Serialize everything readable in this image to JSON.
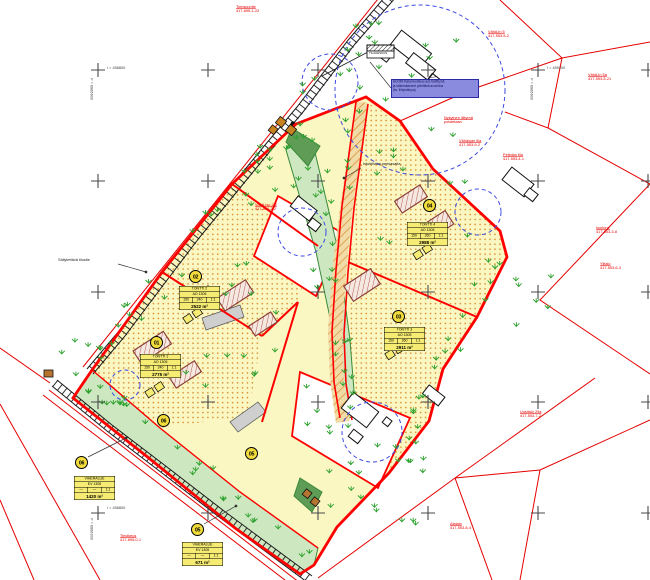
{
  "colors": {
    "boundary": "#FF0000",
    "redline": "#E60000",
    "yellow": "#FAF7C2",
    "table_bg": "#F6EC73",
    "circle_bg": "#F2DC3C",
    "tree": "#2CA02C",
    "green_strip": "#CDE7C0",
    "green_dark": "#5F9C55",
    "tan": "#F1DCA8",
    "hatch_orange": "#D98A2B",
    "hatch_rose": "#B2564E",
    "blue": "#3D49E0",
    "note_bg": "#8A8ADF",
    "note_border": "#2B2BA8",
    "road": "#1A1A1A",
    "cross": "#4A4A4A"
  },
  "note_box": {
    "line1": "HUOM! Rakennettava uusi tieliittymä",
    "line2": "ja näkemäalueet pidettävä avoimina",
    "line3": "(ks. liittymälupa)"
  },
  "tilakeskus_label": "TILAKESKUS",
  "coordinate_crosses": [
    {
      "x_label": "I = 458800",
      "y_label": "P = 6866600"
    },
    {
      "x_label": "I = 459200",
      "y_label": "P = 6866600"
    },
    {
      "x_label": "I = 458800",
      "y_label": "P = 6866200"
    }
  ],
  "parcels": [
    {
      "id": "01",
      "header": "TONTTI 1",
      "code": "AO 1305",
      "c1": "150",
      "c2": "240",
      "c3": "1:1",
      "area": "2775 m²"
    },
    {
      "id": "02",
      "header": "TONTTI 2",
      "code": "AO 1305",
      "c1": "150",
      "c2": "240",
      "c3": "1:1",
      "area": "2522 m²"
    },
    {
      "id": "03",
      "header": "TONTTI 3",
      "code": "AO 1305",
      "c1": "150",
      "c2": "260",
      "c3": "1:1",
      "area": "2911 m²"
    },
    {
      "id": "04",
      "header": "TONTTI 4",
      "code": "AO 1305",
      "c1": "150",
      "c2": "260",
      "c3": "1:1",
      "area": "2988 m²"
    },
    {
      "id": "05",
      "header": "VIHERALUE",
      "code": "EV 1305",
      "c1": "—",
      "c2": "—",
      "c3": "1:1",
      "area": "671 m²"
    },
    {
      "id": "06",
      "header": "VIHERALUE",
      "code": "EV 1305",
      "c1": "—",
      "c2": "—",
      "c3": "1:1",
      "area": "1420 m²"
    }
  ],
  "red_labels": [
    {
      "line1": "Tiensuuntie",
      "line2": "417-895-1-22"
    },
    {
      "line1": "Vähä-In 5",
      "line2": "417-553-5-2"
    },
    {
      "line1": "Vähä-In 5a",
      "line2": "417-553-5-21"
    },
    {
      "line1": "Peltolan tila",
      "line2": "417-553-4-1"
    },
    {
      "line1": "Isorinne",
      "line2": "417-553-3-8"
    },
    {
      "line1": "Ylitalo",
      "line2": "417-553-6-3"
    },
    {
      "line1": "Uusitalo 29a",
      "line2": "417-553-7-2"
    },
    {
      "line1": "Alatalo",
      "line2": "417-553-8-4"
    },
    {
      "line1": "Vähä-Iso 2:2",
      "line2": "417-553-2-2"
    },
    {
      "line1": "Tieoikeus",
      "line2": "417-895-0-1"
    },
    {
      "line1": "Nykyinen liittymä",
      "line2": "poistetaan"
    },
    {
      "line1": "Vähäojan tila",
      "line2": "417-553-9-2"
    }
  ],
  "black_labels": [
    {
      "text": "Säilytettävä tilustie"
    },
    {
      "text": "Istutettava pensasaita"
    }
  ]
}
